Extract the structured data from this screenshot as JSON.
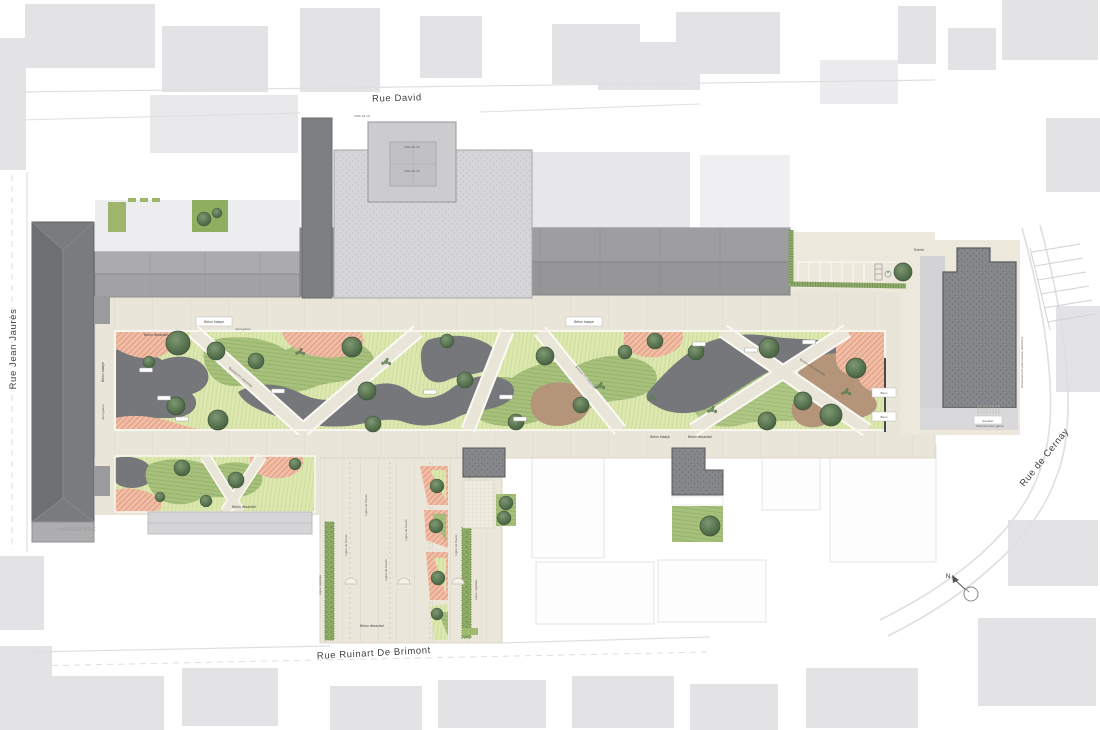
{
  "plan": {
    "streets": {
      "rue_david": "Rue David",
      "rue_jean_jaures": "Rue Jean Jaurès",
      "rue_de_cernay": "Rue de Cernay",
      "rue_ruinart_de_brimont": "Rue Ruinart De Brimont"
    },
    "annotations": {
      "niveau_rdc": "NIVEAU RDC",
      "north": "N",
      "entree": "Entrée",
      "beton_balaye": "Béton balayé",
      "beton_desactive": "Béton désactivé",
      "joint_gazon": "Joint gazon",
      "bordure_p1": "Bordure P1 retournée",
      "ligne_de_paves": "Ligne de Pavés",
      "ligne_vegetale": "Ligne végétale",
      "cheminement_pieton": "Cheminement piéton béton désactivé",
      "cheminement_gazon": "Cheminement gazon",
      "ngf_1": "NGF 91.24",
      "ngf_2": "NGF 91.10",
      "escalier": "Escalier",
      "banc": "Banc"
    },
    "materials_colors": {
      "lawn_green": "#dce8af",
      "planting_green": "#a7c17d",
      "softfall_salmon": "#f0bda6",
      "mineral_grey": "#75777b",
      "stabilized_brown": "#b49579",
      "concrete_sand": "#e9e5d9",
      "hedge_green": "#8fab68",
      "building_dark_grey": "#85878a",
      "building_light_grey": "#d6d6d8",
      "context_grey": "#e3e3e5"
    }
  }
}
